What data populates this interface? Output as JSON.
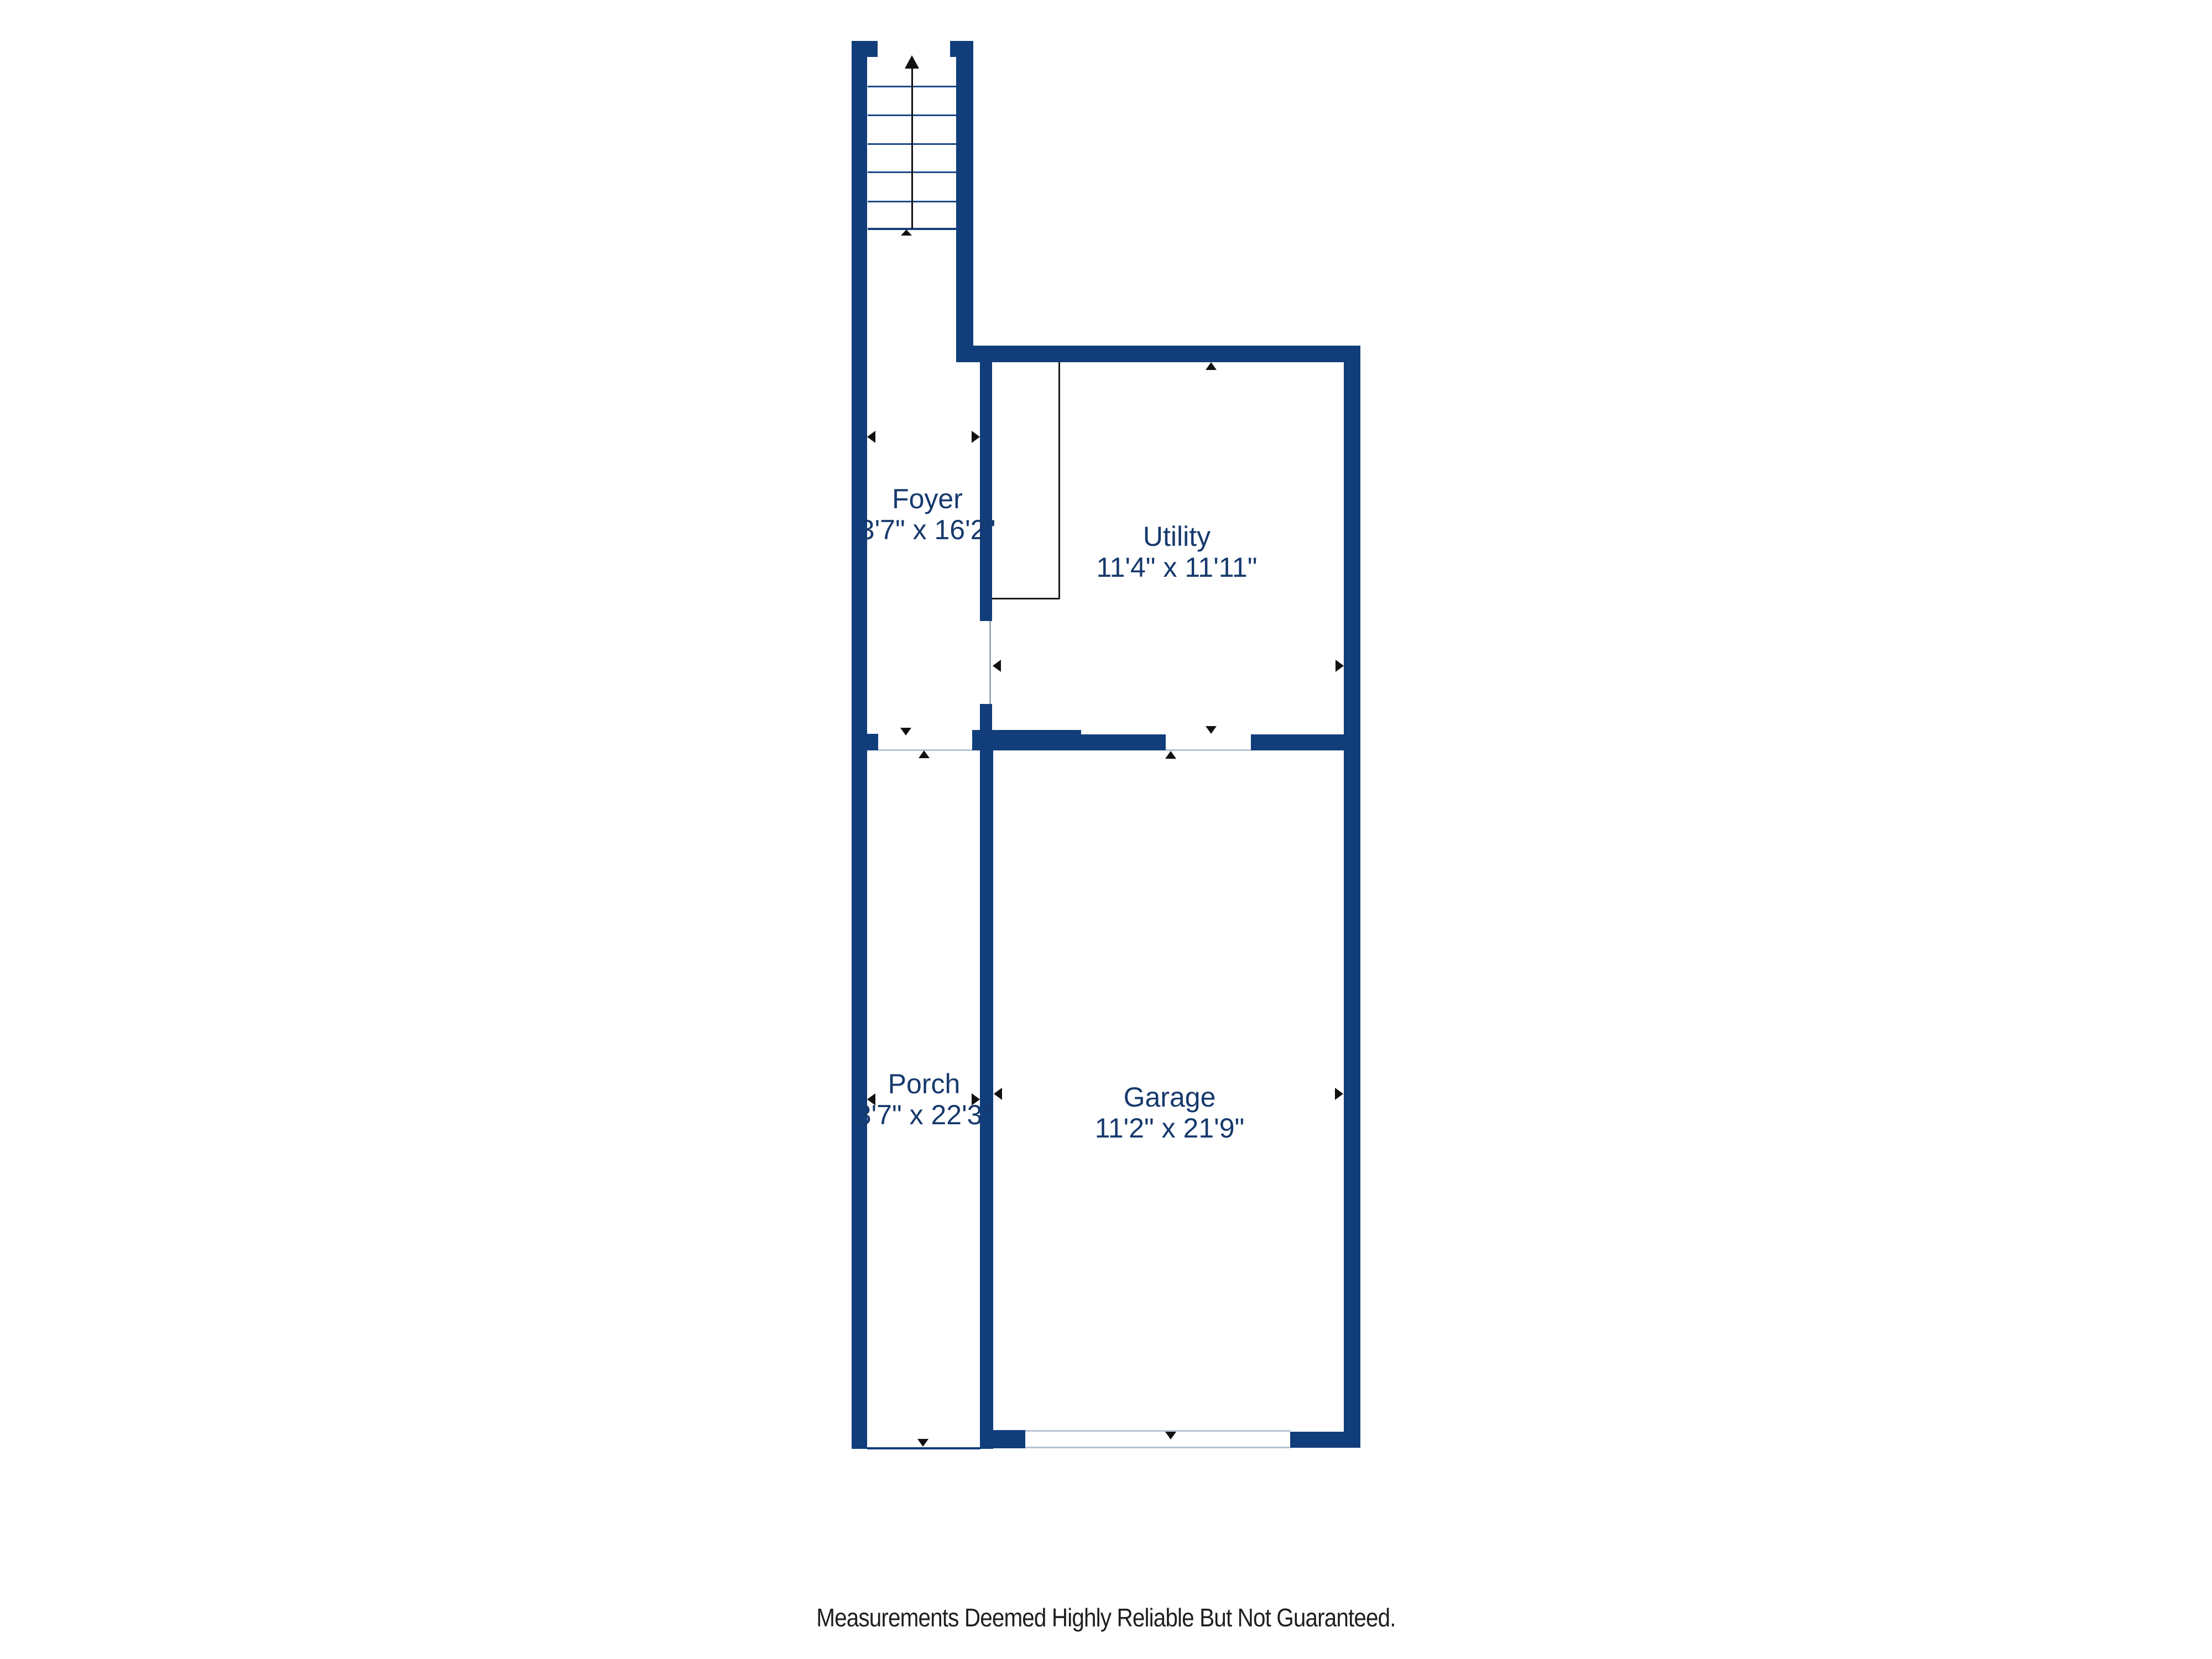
{
  "plan": {
    "title": "Floor plan",
    "rooms": {
      "foyer": {
        "name": "Foyer",
        "dims": "3'7\" x 16'2\""
      },
      "utility": {
        "name": "Utility",
        "dims": "11'4\" x 11'11\""
      },
      "porch": {
        "name": "Porch",
        "dims": "3'7\" x 22'3\""
      },
      "garage": {
        "name": "Garage",
        "dims": "11'2\" x 21'9\""
      }
    },
    "stairs": {
      "direction": "up",
      "treads": 6
    },
    "colors": {
      "wall": "#113d7a",
      "label": "#16396d",
      "tread_line": "#1d4b8a",
      "threshold": "#b7c3d2",
      "annotation": "#111111"
    },
    "footer": "Measurements Deemed Highly Reliable But Not Guaranteed."
  }
}
